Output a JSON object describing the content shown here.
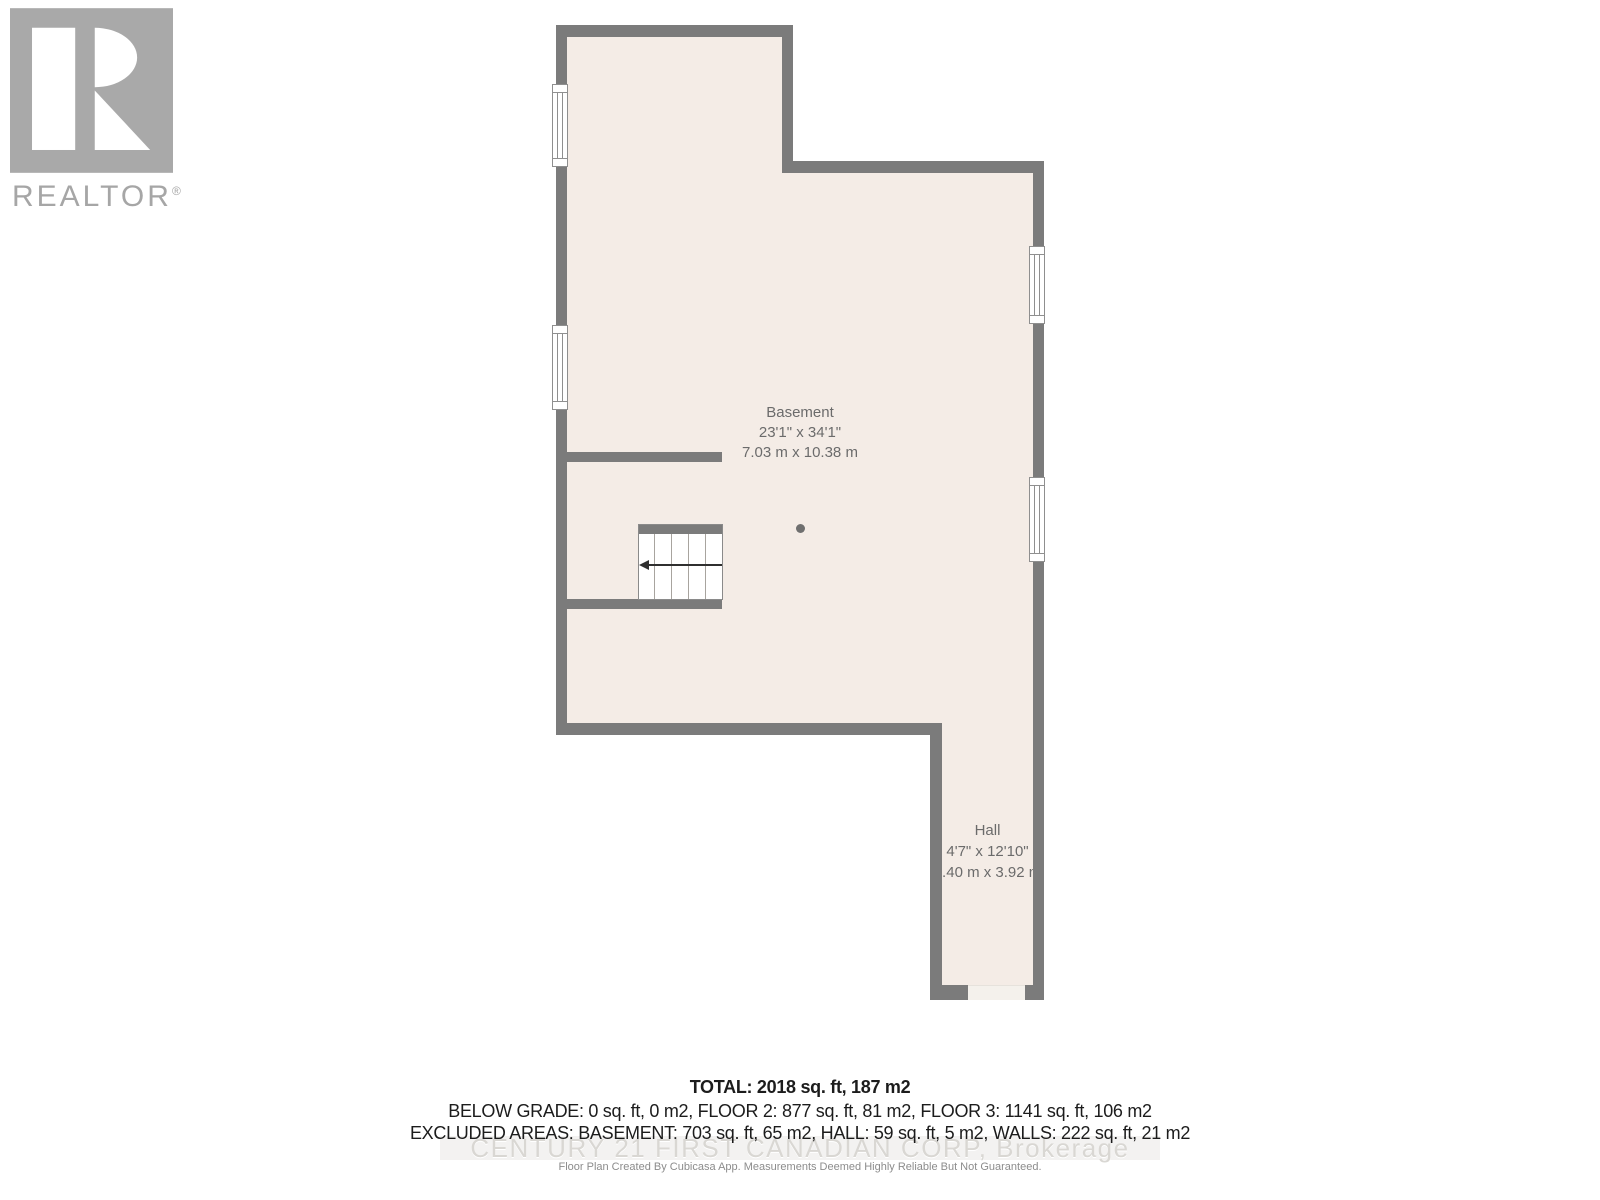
{
  "logo": {
    "brand": "REALTOR",
    "reg": "®"
  },
  "floorplan": {
    "rooms": [
      {
        "name": "Basement",
        "dims_imperial": "23'1\" x 34'1\"",
        "dims_metric": "7.03 m x 10.38 m"
      },
      {
        "name": "Hall",
        "dims_imperial": "4'7\" x 12'10\"",
        "dims_metric": "1.40 m x 3.92 m"
      }
    ],
    "features": {
      "stairs": "stairs-icon with left direction arrow",
      "column": "support-column-dot",
      "window_count": 4
    }
  },
  "footer": {
    "total": "TOTAL: 2018 sq. ft, 187 m2",
    "grade_line": "BELOW GRADE: 0 sq. ft, 0 m2, FLOOR 2: 877 sq. ft, 81 m2, FLOOR 3: 1141 sq. ft, 106 m2",
    "excluded_line": "EXCLUDED AREAS: BASEMENT: 703 sq. ft, 65 m2, HALL: 59 sq. ft, 5 m2, WALLS: 222 sq. ft, 21 m2",
    "watermark": "CENTURY 21 FIRST CANADIAN CORP, Brokerage",
    "disclaimer": "Floor Plan Created By Cubicasa App. Measurements Deemed Highly Reliable But Not Guaranteed."
  },
  "colors": {
    "wall": "#7b7b7b",
    "floor": "#f4ece6",
    "room_text": "#6b6b6b",
    "footer_text": "#1c1c1c",
    "watermark": "#d9d7d3",
    "logo_gray": "#a9a9a9"
  }
}
